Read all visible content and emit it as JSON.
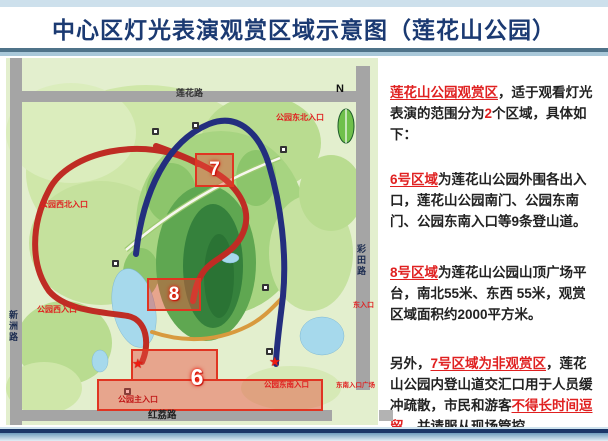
{
  "header": {
    "title": "中心区灯光表演观赏区域示意图（莲花山公园）"
  },
  "colors": {
    "accent_red": "#e02020",
    "title_navy": "#1b3a72",
    "map_green": "#cfe7a9",
    "route_red": "#bf2c24",
    "route_navy": "#232e7e",
    "road_gray": "#a5a5a5"
  },
  "map": {
    "compass": "N",
    "icons": {
      "star": "★"
    },
    "roads": {
      "lianhua": "莲花路",
      "xinzhou": "新洲路",
      "caitian": "彩田路",
      "hongli": "红荔路"
    },
    "labels": {
      "ne_entrance": "公园东北入口",
      "nw_entrance": "公园西北入口",
      "w_entrance": "公园西入口",
      "e_entrance": "东入口",
      "main_entrance": "公园主入口",
      "se_entrance": "公园东南入口",
      "se_plaza": "东南入口广场"
    },
    "areas": {
      "a7": "7",
      "a8": "8",
      "a6": "6"
    }
  },
  "panel": {
    "para1": {
      "highlight": "莲花山公园观赏区",
      "t1": "，适于观看灯光表演的范围分为",
      "num": "2",
      "t2": "个区域，具体如下："
    },
    "para2": {
      "highlight": "6号区域",
      "t1": "为莲花山公园外围各出入口，莲花山公园南门、公园东南门、公园东南入口等9条登山道。"
    },
    "para3": {
      "highlight": "8号区域",
      "t1": "为莲花山公园山顶广场平台，南北55米、东西 55米，观赏区域面积约2000平方米。"
    },
    "para4": {
      "t0": "另外，",
      "highlight1": "7号区域为非观赏区",
      "t1": "，莲花山公园内登山道交汇口用于人员缓冲疏散，市民和游客",
      "highlight2": "不得长时间逗留",
      "t2": "，并请服从现场管控。"
    }
  }
}
